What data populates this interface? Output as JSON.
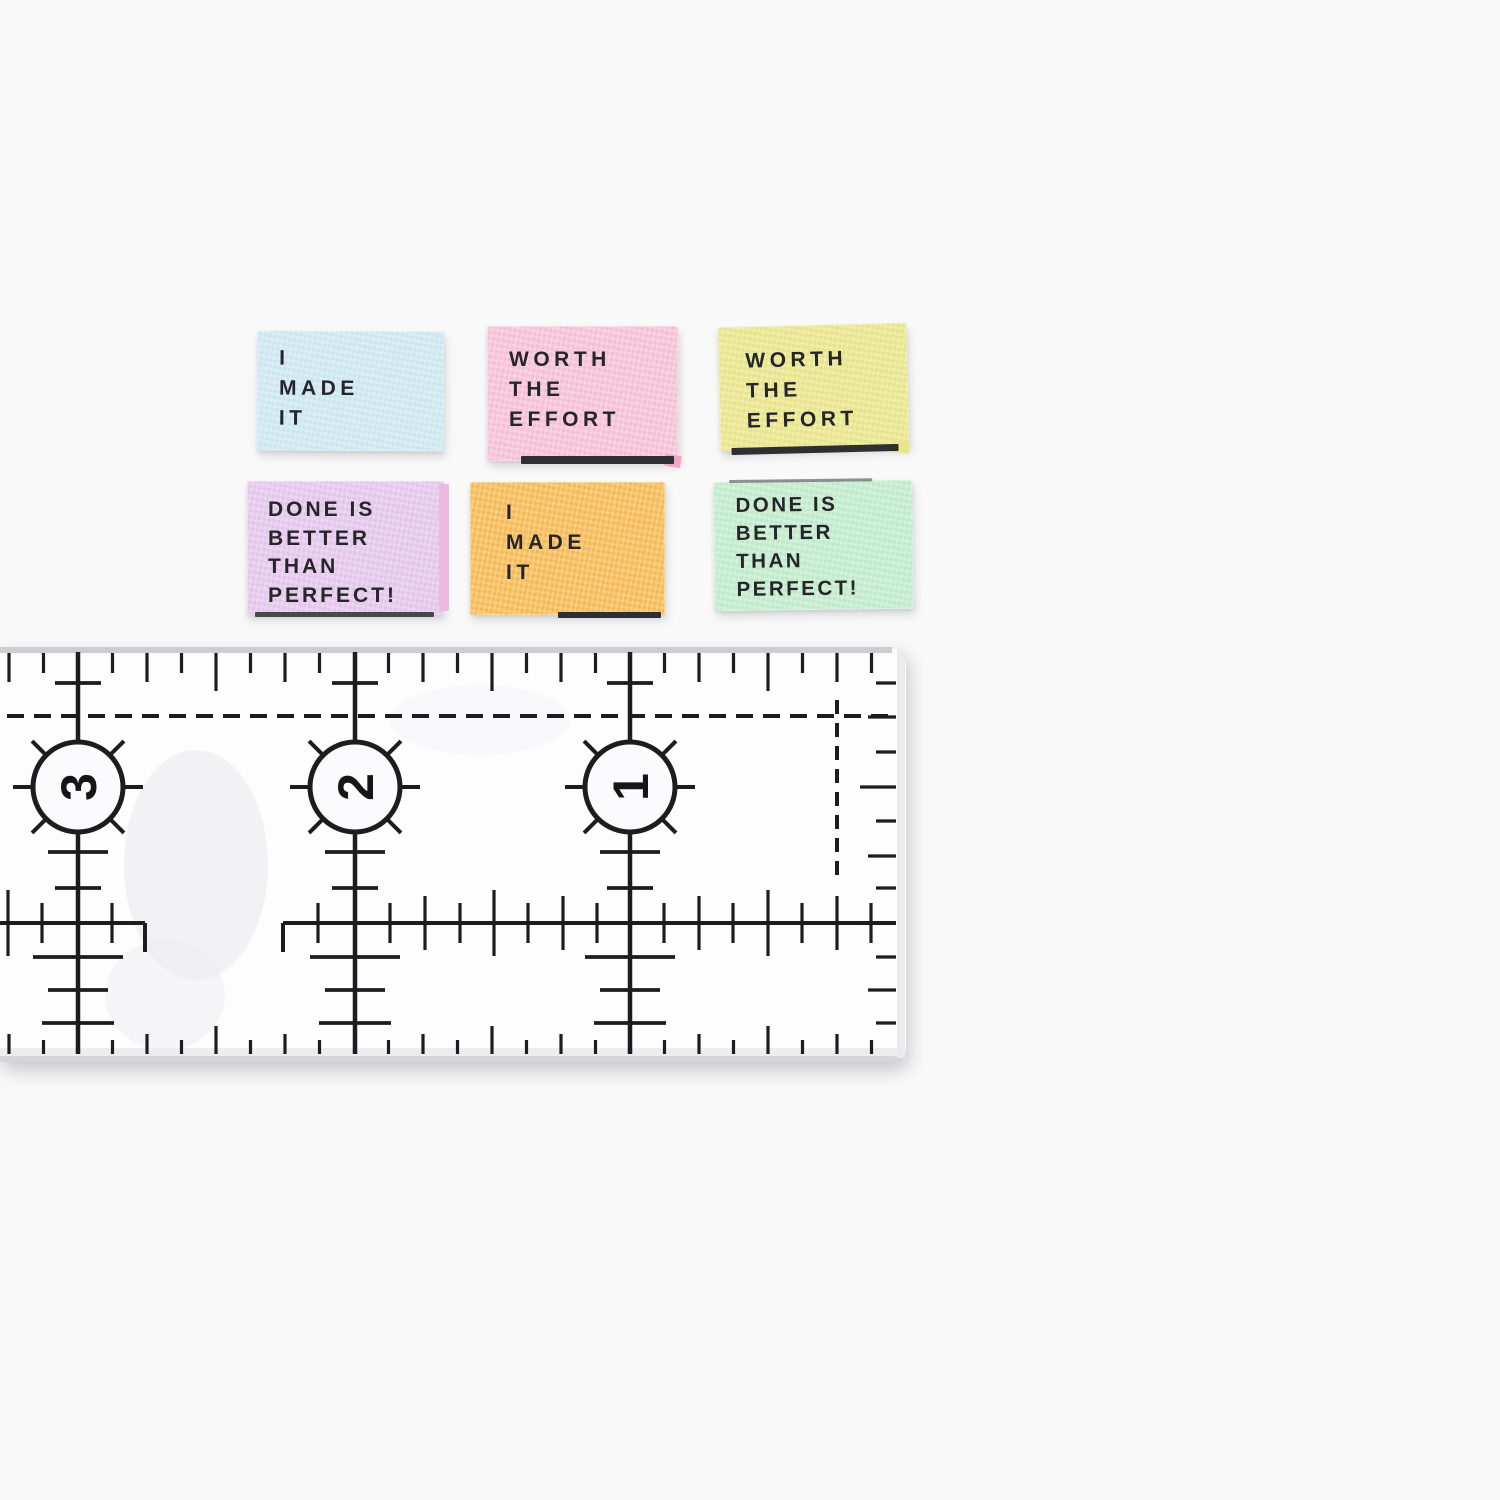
{
  "background_color": "#f9f9f9",
  "labels": [
    {
      "name": "blue",
      "color": "#cfe9f3",
      "text": "I MADE IT",
      "lines": [
        "I",
        "MADE",
        "IT"
      ]
    },
    {
      "name": "pink",
      "color": "#f8c3d9",
      "text": "WORTH THE EFFORT",
      "lines": [
        "WORTH",
        "THE",
        "EFFORT"
      ]
    },
    {
      "name": "yellow",
      "color": "#ebe88e",
      "text": "WORTH THE EFFORT",
      "lines": [
        "WORTH",
        "THE",
        "EFFORT"
      ]
    },
    {
      "name": "lavender",
      "color": "#e6c9ee",
      "text": "DONE IS BETTER THAN PERFECT!",
      "lines": [
        "DONE IS",
        "BETTER",
        "THAN",
        "PERFECT!"
      ]
    },
    {
      "name": "orange",
      "color": "#f8bd59",
      "text": "I MADE IT",
      "lines": [
        "I",
        "MADE",
        "IT"
      ]
    },
    {
      "name": "mint",
      "color": "#c4edce",
      "text": "DONE IS BETTER THAN PERFECT!",
      "lines": [
        "DONE IS",
        "BETTER",
        "THAN",
        "PERFECT!"
      ]
    }
  ],
  "ruler": {
    "ink_color": "#1d1d1f",
    "numbers": [
      "3",
      "2",
      "1"
    ]
  }
}
